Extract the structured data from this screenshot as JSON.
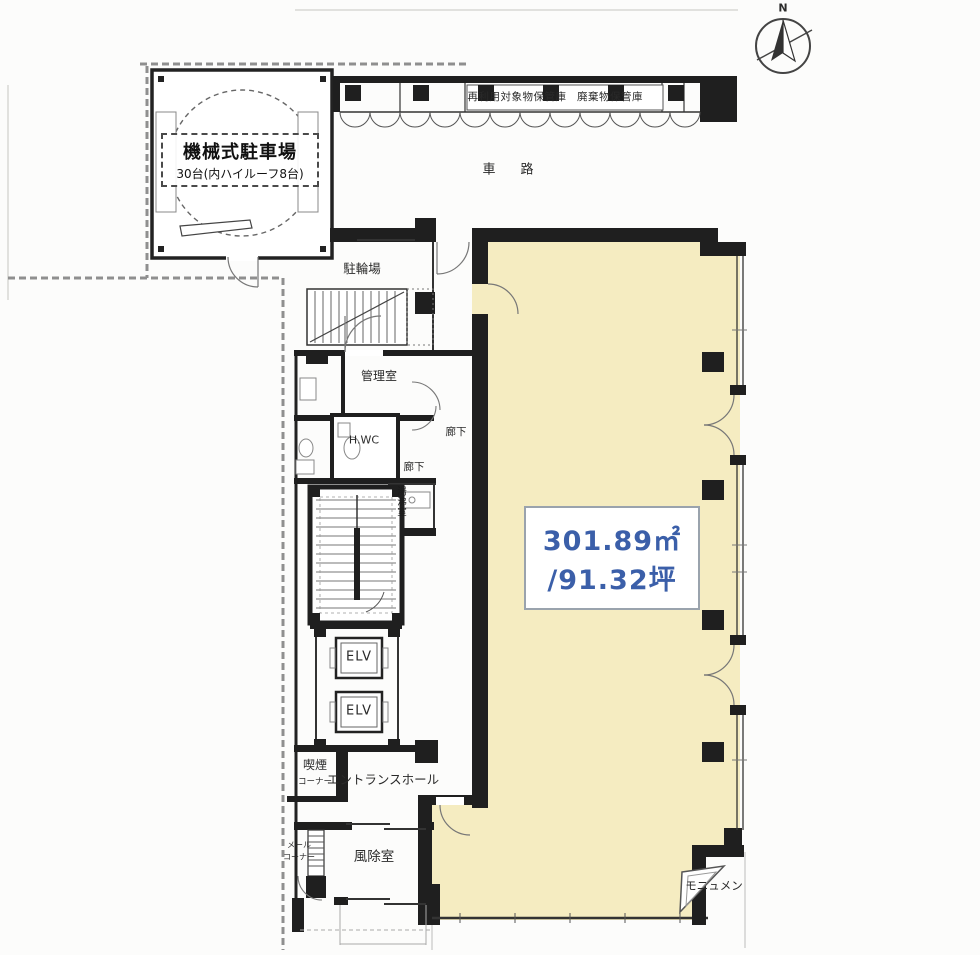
{
  "meta": {
    "type": "building-floor-plan",
    "floor": "1F"
  },
  "colors": {
    "tenant_fill": "#f5ecc1",
    "wall": "#1f1f1f",
    "area_text": "#3b5fa9",
    "boundary": "#909090",
    "paper": "#fcfcfb"
  },
  "compass": {
    "north_label": "N"
  },
  "parking": {
    "name": "機械式駐車場",
    "capacity": "30台(内ハイルーフ8台)"
  },
  "storage": {
    "label1": "再利用対象物保管庫",
    "label2": "廃棄物保管庫"
  },
  "driveway": {
    "label": "車　路"
  },
  "rooms": {
    "bicycle_parking": "駐輪場",
    "management_room": "管理室",
    "toilet": "H.WC",
    "corridor_upper": "廊下",
    "corridor_lower": "廊下",
    "hot_water_room": "湯沸室",
    "elevator_1": "ELV",
    "elevator_2": "ELV",
    "entrance_hall": "エントランスホール",
    "smoking_corner_line1": "喫煙",
    "smoking_corner_line2": "コーナー",
    "mail_corner_line1": "メール",
    "mail_corner_line2": "コーナー",
    "windbreak_room": "風除室",
    "monument": "モニュメン"
  },
  "tenant_area": {
    "size_sqm": "301.89㎡",
    "size_tsubo": "/91.32坪"
  }
}
